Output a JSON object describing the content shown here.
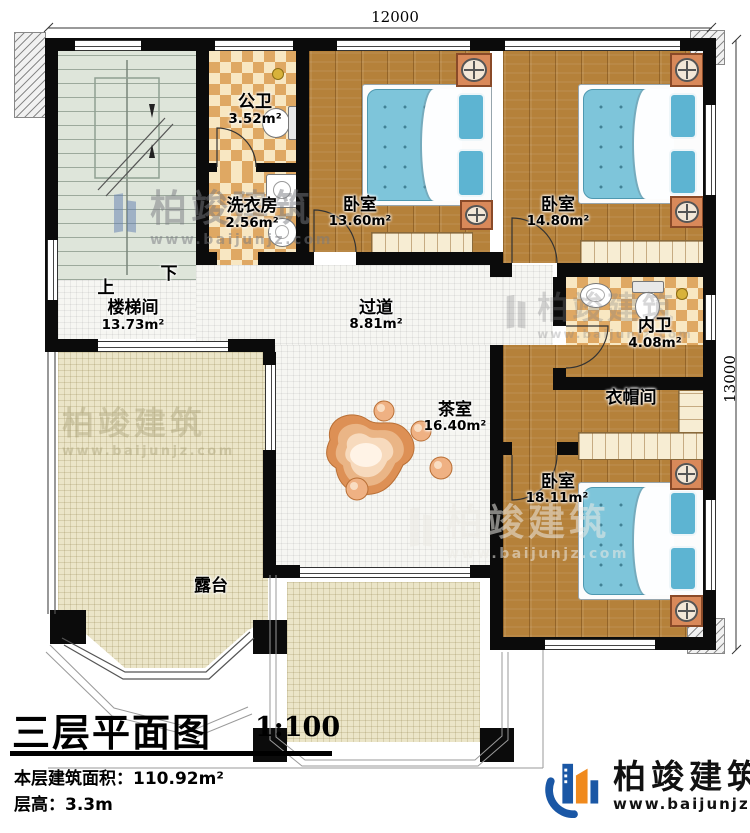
{
  "dimensions": {
    "top": "12000",
    "right": "13000"
  },
  "stair": {
    "up": "上",
    "down": "下"
  },
  "rooms": {
    "stairwell": {
      "name": "楼梯间",
      "area": "13.73m²"
    },
    "public_bath": {
      "name": "公卫",
      "area": "3.52m²"
    },
    "laundry": {
      "name": "洗衣房",
      "area": "2.56m²"
    },
    "bedroom_top_middle": {
      "name": "卧室",
      "area": "13.60m²"
    },
    "bedroom_top_right": {
      "name": "卧室",
      "area": "14.80m²"
    },
    "inner_bath": {
      "name": "内卫",
      "area": "4.08m²"
    },
    "cloakroom": {
      "name": "衣帽间"
    },
    "bedroom_bottom_right": {
      "name": "卧室",
      "area": "18.11m²"
    },
    "hallway": {
      "name": "过道",
      "area": "8.81m²"
    },
    "tea_room": {
      "name": "茶室",
      "area": "16.40m²"
    },
    "terrace": {
      "name": "露台"
    }
  },
  "title_block": {
    "title": "三层平面图",
    "scale": "1:100",
    "floor_area": "本层建筑面积：110.92m²",
    "floor_height": "层高：3.3m"
  },
  "branding": {
    "company": "柏竣建筑",
    "website": "www.baijunjz.com"
  },
  "watermark": {
    "company": "柏竣建筑",
    "website": "www.baijunjz.com"
  }
}
